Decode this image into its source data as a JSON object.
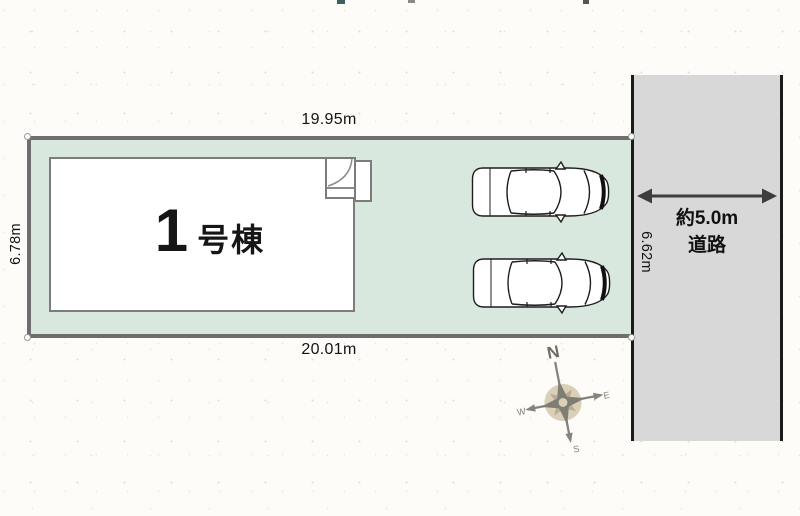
{
  "site_plan": {
    "building": {
      "number": "1",
      "suffix": "号棟"
    },
    "dimensions": {
      "top": "19.95m",
      "bottom": "20.01m",
      "left": "6.78m",
      "right": "6.62m"
    },
    "road": {
      "width_label": "約5.0m",
      "type_label": "道路"
    },
    "compass": {
      "north": "N",
      "east": "E",
      "south": "S",
      "west": "W"
    },
    "colors": {
      "lot_fill": "#d9e8de",
      "lot_border": "#6e6e6e",
      "road_fill": "#d8d8d8",
      "road_border": "#1b1b1b",
      "building_fill": "#ffffff",
      "building_border": "#7c7c7c",
      "arrow": "#3d3d3d",
      "compass_center": "#dccfb8",
      "text": "#131313"
    }
  }
}
